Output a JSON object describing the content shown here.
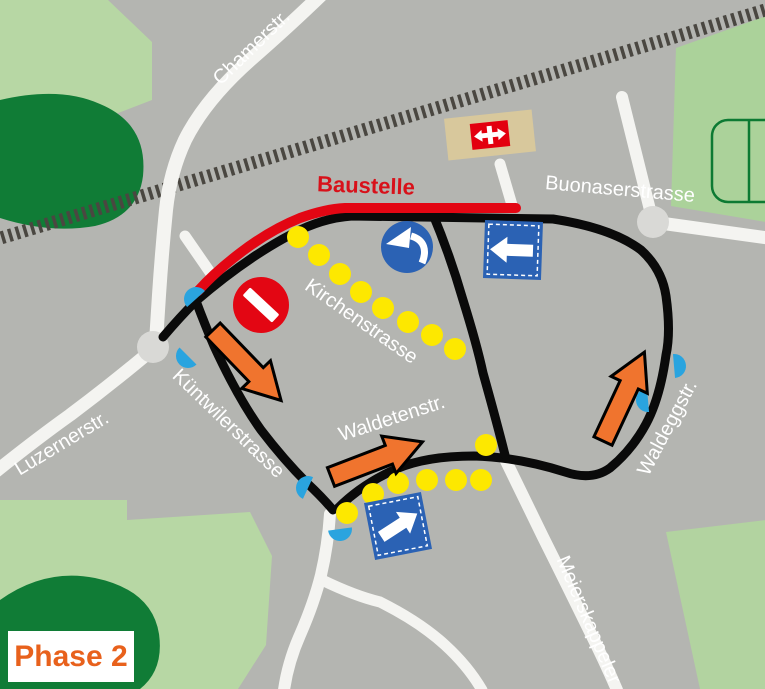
{
  "map": {
    "phase_badge": "Phase 2",
    "construction_label": "Baustelle",
    "streets": {
      "chamerstr": "Chamerstr.",
      "buonaserstrasse": "Buonaserstrasse",
      "kirchenstrasse": "Kirchenstrasse",
      "waldetenstr": "Waldetenstr.",
      "kuentwilerstrasse": "Küntwilerstrasse",
      "luzernerstr": "Luzernerstr.",
      "waldeggstr": "Waldeggstr.",
      "meierskappelerstr": "Meierskappeler",
      "kirchenstrasse_closed_note": "",
      "baustelle_street": ""
    },
    "colors": {
      "map_background": "#b4b5b1",
      "road_white": "#f4f4f1",
      "roundabout_gray": "#d9d9d6",
      "railway_dark": "#4a4741",
      "detour_route_black": "#0a0a0a",
      "construction_red": "#e30613",
      "detour_dots_yellow": "#fde800",
      "direction_arrow_orange": "#f0742e",
      "traffic_sign_blue": "#2b62b4",
      "side_street_marker_blue": "#2aa4df",
      "green_dark": "#107c36",
      "green_light": "#b7d7a4",
      "station_tan": "#d8c89c",
      "sbb_red": "#e3000f",
      "phase_text_orange": "#e8611c"
    }
  }
}
